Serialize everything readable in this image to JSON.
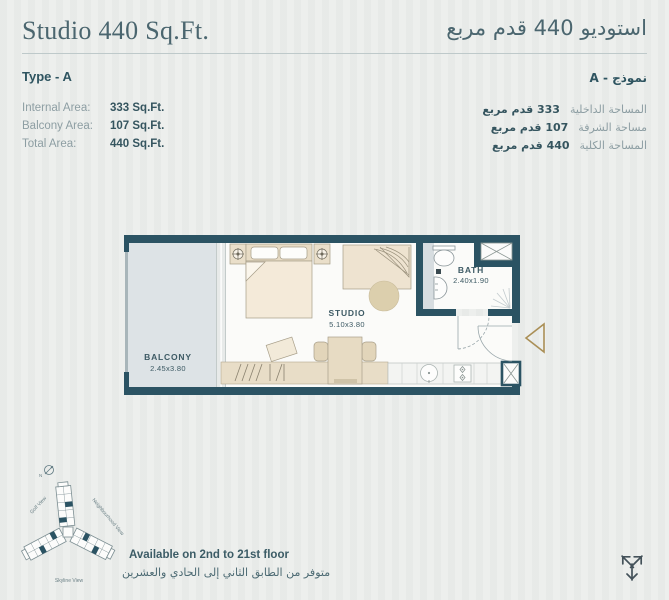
{
  "header": {
    "title_en": "Studio 440 Sq.Ft.",
    "title_ar": "استوديو 440 قدم مربع"
  },
  "details": {
    "type_en": "Type - A",
    "type_ar": "نموذج - A",
    "rows_en": [
      {
        "label": "Internal Area:",
        "value": "333 Sq.Ft."
      },
      {
        "label": "Balcony Area:",
        "value": "107 Sq.Ft."
      },
      {
        "label": "Total Area:",
        "value": "440 Sq.Ft."
      }
    ],
    "rows_ar": [
      {
        "label": "المساحة الداخلية",
        "value": "333 قدم مربع"
      },
      {
        "label": "مساحة الشرفة",
        "value": "107 قدم مربع"
      },
      {
        "label": "المساحة الكلية",
        "value": "440 قدم مربع"
      }
    ]
  },
  "floorplan": {
    "rooms": [
      {
        "name": "BALCONY",
        "dims": "2.45x3.80"
      },
      {
        "name": "STUDIO",
        "dims": "5.10x3.80"
      },
      {
        "name": "BATH",
        "dims": "2.40x1.90"
      }
    ]
  },
  "site": {
    "compass": "N",
    "views": [
      "Golf View",
      "Neighbourhood View",
      "Skyline View"
    ]
  },
  "footer": {
    "availability_en": "Available on 2nd to 21st floor",
    "availability_ar": "متوفر من الطابق الثاني إلى الحادي والعشرين"
  },
  "colors": {
    "wall": "#2b5363",
    "accent_gold": "#aa8f56",
    "furniture_beige": "#e8dcc5",
    "balcony_fill": "#dde3e6",
    "text_dark": "#35555f",
    "text_gray": "#8d9ea3"
  }
}
